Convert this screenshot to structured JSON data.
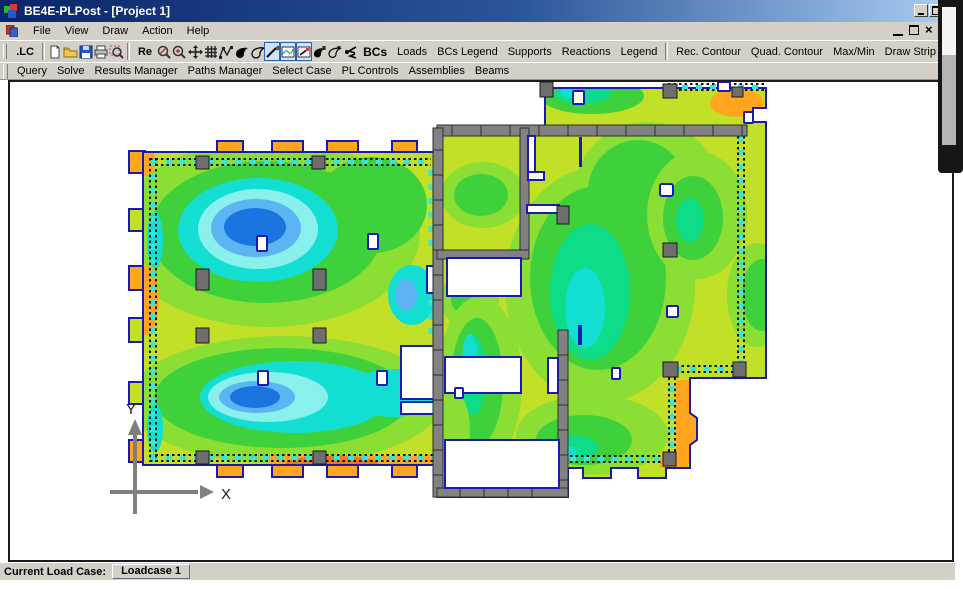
{
  "window": {
    "title": "BE4E-PLPost - [Project 1]"
  },
  "menu": {
    "items": [
      "File",
      "View",
      "Draw",
      "Action",
      "Help"
    ]
  },
  "toolbar1": {
    "lc": ".LC",
    "re": "Re",
    "bcs": "BCs",
    "buttons": [
      "Loads",
      "BCs Legend",
      "Supports",
      "Reactions",
      "Legend",
      "Rec. Contour",
      "Quad. Contour",
      "Max/Min",
      "Draw Strip"
    ]
  },
  "toolbar2": {
    "buttons": [
      "Query",
      "Solve",
      "Results Manager",
      "Paths Manager",
      "Select Case",
      "PL Controls",
      "Assemblies",
      "Beams"
    ]
  },
  "statusbar": {
    "label": "Current Load Case:",
    "value": "Loadcase 1"
  },
  "plot": {
    "x_axis_label": "X",
    "y_axis_label": "Y",
    "palette": {
      "base": "#c3e028",
      "light_green": "#8ade34",
      "green": "#3ed13c",
      "spring": "#0fdc86",
      "cyan": "#12ded2",
      "pale_cyan": "#8af0ec",
      "light_blue": "#5cb4f2",
      "blue": "#1b74e0",
      "orange": "#ffa51e",
      "deep_orange": "#f47416",
      "strip_cyan": "#35e6da",
      "wall": "#828282",
      "column": "#6e6e6e",
      "outline": "#1a1aae",
      "axis_gray": "#7f7f7f"
    }
  }
}
